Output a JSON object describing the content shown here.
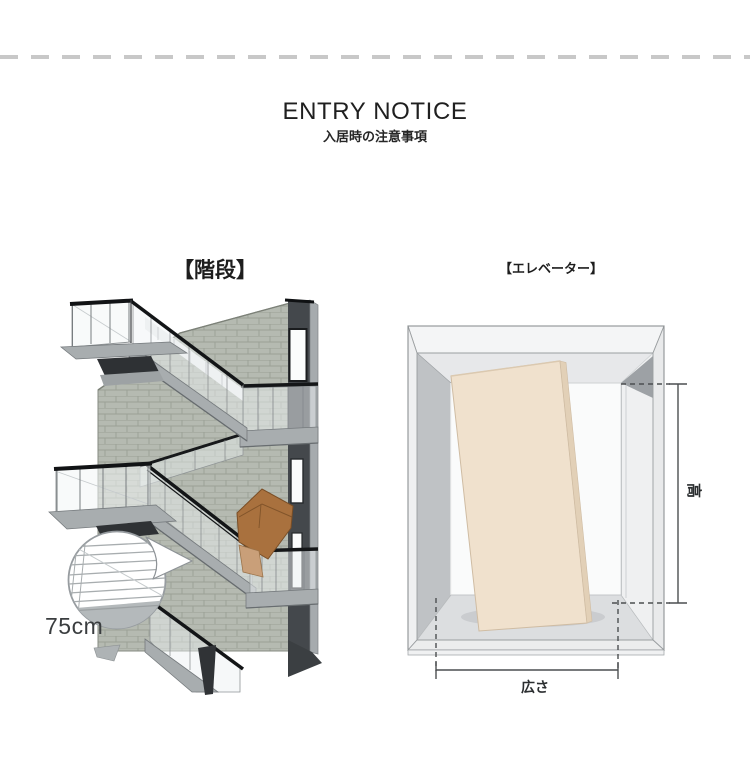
{
  "header": {
    "title": "ENTRY NOTICE",
    "subtitle": "入居時の注意事項"
  },
  "sections": {
    "stairs": {
      "label": "【階段】",
      "measurement": "75cm"
    },
    "elevator": {
      "label": "【エレベーター】",
      "height_label": "高",
      "width_label": "広さ"
    }
  },
  "colors": {
    "background": "#ffffff",
    "divider_dash": "#c8c8c8",
    "text_primary": "#222222",
    "brick_wall": "#b5bab1",
    "dark_wall": "#44484c",
    "slab_gray": "#a8adaf",
    "handrail_black": "#131517",
    "cardboard_box": "#a9713e",
    "panel_beige": "#f0e1cd",
    "dimension_line": "#4c4f51"
  }
}
